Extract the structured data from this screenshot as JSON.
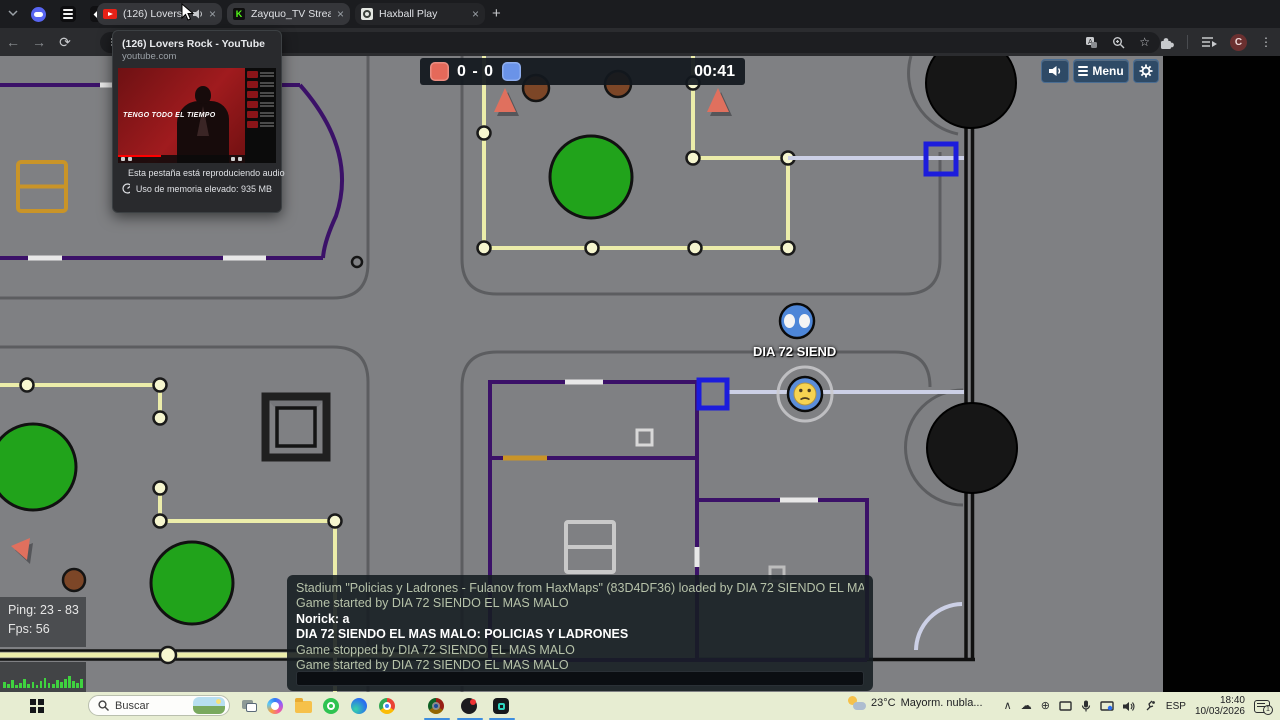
{
  "browser": {
    "pinned_tabs": [
      {
        "icon": "discord-pinned-icon"
      },
      {
        "icon": "layers-pinned-icon"
      },
      {
        "icon": "diamond-pinned-icon"
      }
    ],
    "tabs": [
      {
        "title": "(126) Lovers Rock - YouTube",
        "favicon": "youtube-icon",
        "audio": true,
        "close": "×"
      },
      {
        "title": "Zayquo_TV Stream - Watch Live",
        "favicon": "kick-icon",
        "close": "×"
      },
      {
        "title": "Haxball Play",
        "favicon": "haxball-icon",
        "close": "×"
      }
    ],
    "new_tab_label": "+",
    "address_text": "h",
    "profile_initial": "C",
    "tooltip": {
      "title": "(126) Lovers Rock - YouTube",
      "domain": "youtube.com",
      "video_caption": "TENGO TODO EL TIEMPO",
      "audio_status": "Esta pestaña está reproduciendo audio",
      "memory_status": "Uso de memoria elevado: 935 MB"
    }
  },
  "game": {
    "score": {
      "display": "0 - 0",
      "timer": "00:41",
      "red_color": "#e5695a",
      "blue_color": "#6a93e8"
    },
    "menu_button": "Menu",
    "player_label": "DIA 72 SIEND",
    "stats": {
      "ping": "Ping: 23 - 83",
      "fps": "Fps: 56"
    },
    "perf_bars": [
      6,
      4,
      8,
      3,
      5,
      9,
      4,
      6,
      3,
      7,
      10,
      5,
      4,
      8,
      6,
      9,
      12,
      7,
      5,
      9
    ],
    "chat": {
      "messages": [
        {
          "kind": "system",
          "text": "Stadium \"Policias y Ladrones - Fulanov from HaxMaps\" (83D4DF36) loaded by DIA 72 SIENDO EL MAS MALO"
        },
        {
          "kind": "system",
          "text": "Game started by DIA 72 SIENDO EL MAS MALO"
        },
        {
          "kind": "player",
          "text": "Norick: a"
        },
        {
          "kind": "player",
          "text": "DIA 72 SIENDO EL MAS MALO: POLICIAS Y LADRONES"
        },
        {
          "kind": "system",
          "text": "Game stopped by DIA 72 SIENDO EL MAS MALO"
        },
        {
          "kind": "system",
          "text": "Game started by DIA 72 SIENDO EL MAS MALO"
        }
      ],
      "input_value": ""
    }
  },
  "taskbar": {
    "search_placeholder": "Buscar",
    "weather": {
      "temp": "23°C",
      "condition": "Mayorm. nubla..."
    },
    "language": "ESP",
    "time": "18:40",
    "date": "10/03/2026",
    "notification_count": "1"
  }
}
